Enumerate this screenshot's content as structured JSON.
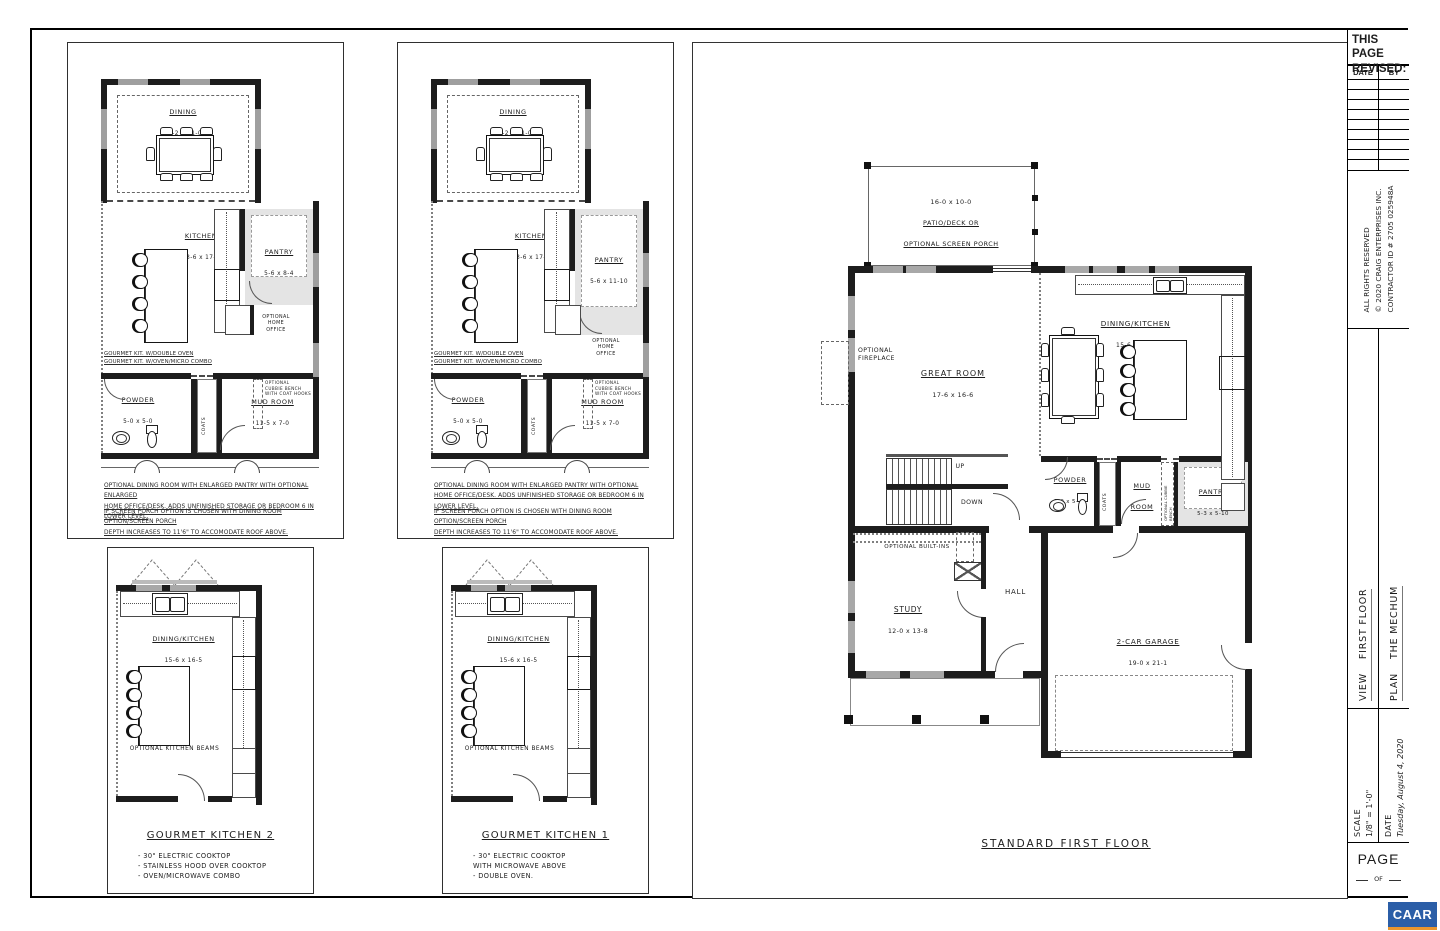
{
  "sheet": {
    "paper": "#ffffff",
    "ink": "#1d1d1d"
  },
  "shared": {
    "home_office": "OPTIONAL\nHOME\nOFFICE",
    "cubbie_hooks": "OPTIONAL\nCUBBIE BENCH\nWITH COAT HOOKS",
    "gourmet_note": "GOURMET KIT. W/DOUBLE OVEN\nGOURMET KIT. W/OVEN/MICRO COMBO",
    "coats": "COATS",
    "beams": "OPTIONAL KITCHEN BEAMS"
  },
  "optionA": {
    "dining": "DINING",
    "dining_dims": "14-2 x 11-0",
    "kitchen": "KITCHEN",
    "kitchen_dims": "13-6 x 17-9",
    "pantry": "PANTRY",
    "pantry_dims": "5-6 x 8-4",
    "powder": "POWDER",
    "powder_dims": "5-0 x 5-0",
    "mud": "MUD ROOM",
    "mud_dims": "11-5 x 7-0",
    "note1": "OPTIONAL DINING ROOM WITH ENLARGED PANTRY WITH OPTIONAL ENLARGED\nHOME OFFICE/DESK. ADDS UNFINISHED STORAGE OR BEDROOM 6 IN LOWER LEVEL.",
    "note2": "IF SCREEN PORCH OPTION IS CHOSEN WITH DINING ROOM OPTION/SCREEN PORCH\nDEPTH INCREASES TO 11'6\" TO ACCOMODATE ROOF ABOVE."
  },
  "optionB": {
    "dining": "DINING",
    "dining_dims": "14-2 x 11-0",
    "kitchen": "KITCHEN",
    "kitchen_dims": "13-6 x 17-9",
    "pantry": "PANTRY",
    "pantry_dims": "5-6 x 11-10",
    "powder": "POWDER",
    "powder_dims": "5-0 x 5-0",
    "mud": "MUD ROOM",
    "mud_dims": "11-5 x 7-0",
    "note1": "OPTIONAL DINING ROOM WITH ENLARGED PANTRY WITH OPTIONAL\nHOME OFFICE/DESK. ADDS UNFINISHED STORAGE OR BEDROOM 6 IN LOWER LEVEL.",
    "note2": "IF SCREEN PORCH OPTION IS CHOSEN WITH DINING ROOM OPTION/SCREEN PORCH\nDEPTH INCREASES TO 11'6\" TO ACCOMODATE ROOF ABOVE."
  },
  "gourmet2": {
    "room": "DINING/KITCHEN",
    "room_dims": "15-6 x 16-5",
    "title": "GOURMET KITCHEN 2",
    "bullets": "- 30\" ELECTRIC COOKTOP\n- STAINLESS HOOD OVER COOKTOP\n- OVEN/MICROWAVE COMBO"
  },
  "gourmet1": {
    "room": "DINING/KITCHEN",
    "room_dims": "15-6 x 16-5",
    "title": "GOURMET KITCHEN 1",
    "bullets": "- 30\" ELECTRIC COOKTOP\n  WITH MICROWAVE ABOVE\n- DOUBLE OVEN."
  },
  "main": {
    "patio_dims": "16-0 x 10-0",
    "patio_name": "PATIO/DECK OR\nOPTIONAL SCREEN PORCH",
    "fireplace": "OPTIONAL\nFIREPLACE",
    "great": "GREAT ROOM",
    "great_dims": "17-6 x 16-6",
    "dk": "DINING/KITCHEN",
    "dk_dims": "15-6 x 16-5",
    "up": "UP",
    "down": "DOWN",
    "builtins": "OPTIONAL BUILT-INS",
    "powder": "POWDER",
    "powder_dims": "5-0 x 5-10",
    "mud": "MUD\nROOM",
    "cubbie": "OPTIONAL CUBBIE\nBENCH",
    "pantry": "PANTRY",
    "pantry_dims": "5-3 x 5-10",
    "study": "STUDY",
    "study_dims": "12-0 x 13-8",
    "hall": "HALL",
    "garage": "2-CAR GARAGE",
    "garage_dims": "19-0 x 21-1",
    "caption": "STANDARD FIRST FLOOR"
  },
  "title_block": {
    "revised1": "THIS PAGE",
    "revised2": "REVISED:",
    "date_col": "DATE",
    "by_col": "BY",
    "rights": "ALL RIGHTS RESERVED",
    "copyright": "© 2020 CRAIG ENTERPRISES INC.",
    "contractor": "CONTRACTOR ID # 2705 025948A",
    "view_label": "VIEW",
    "view_value": "FIRST FLOOR",
    "plan_label": "PLAN",
    "plan_value": "THE MECHUM",
    "scale_label": "SCALE",
    "scale_value": "1/8\" = 1'-0\"",
    "date_label": "DATE",
    "date_value": "Tuesday, August 4, 2020",
    "page_label": "PAGE",
    "of_label": "OF"
  },
  "logo": {
    "text": "CAAR",
    "bg": "#2b5ea7",
    "bar": "#e9952e"
  }
}
